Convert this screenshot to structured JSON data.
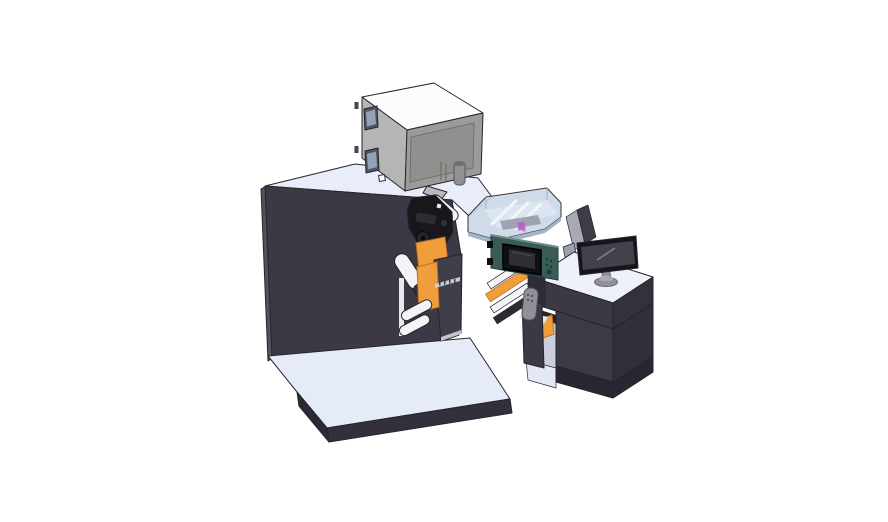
{
  "meta": {
    "description": "Isometric 3D CAD rendering of an industrial label printing press: large dark cabinet with gray feeder box on top, web rollers and orange guide plates, transparent guard enclosure, teal control panel with small display, and an operator desk with a monitor, all on light base platforms against a white background",
    "canvas": {
      "width": 888,
      "height": 522
    },
    "background": "#ffffff"
  },
  "palette": {
    "outline": "#26252e",
    "white": "#ffffff",
    "machineFace": "#3a3944",
    "machineEdge": "#52515c",
    "machineTop": "#e9edf9",
    "deskTop": "#eef1fa",
    "platformTop": "#e6ebf8",
    "platformSide": "#31303b",
    "platformSideDark": "#2b2a34",
    "boxTop": "#fcfcfc",
    "boxLeft": "#b5b5b3",
    "boxFront": "#9b9b99",
    "boxRecess": "#90908e",
    "windowFrame": "#4d5664",
    "windowGlass": "#93a2b6",
    "metalGray": "#909096",
    "metalDark": "#66666c",
    "mechBlack": "#17171c",
    "mechGray": "#3f3e49",
    "orange": "#f09d3c",
    "orangeDark": "#c07426",
    "roller": "#f4f4f7",
    "capDark": "#302f39",
    "teal": "#3a5c56",
    "tealDark": "#223f3a",
    "screenBlack": "#0f0f14",
    "screenInner": "#2f2e37",
    "glassBlue": "#cdd9e8",
    "glassEdge": "#9fb0c4",
    "slatWhite": "#f3f6fa",
    "purple": "#b765c9",
    "bayInterior": "#c9cfdf",
    "bayFloor": "#e3e8f5",
    "monitorBezel": "#15151a",
    "monitorScreen": "#43424c",
    "plinth": "#282731",
    "bandDark": "#32313c",
    "cabLeft": "#3b3a45",
    "cabRight": "#302f3a"
  },
  "objects": [
    {
      "name": "top-feeder-box",
      "label": "Gray feeder / laser unit box on machine top",
      "color": "#9b9b99"
    },
    {
      "name": "main-machine-cabinet",
      "label": "Main press cabinet",
      "color": "#3a3944"
    },
    {
      "name": "print-mechanism",
      "label": "Print head mechanism with gears",
      "color": "#17171c"
    },
    {
      "name": "web-rollers",
      "label": "White web rollers",
      "color": "#f4f4f7"
    },
    {
      "name": "guide-plates",
      "label": "Orange guide plates",
      "color": "#f09d3c"
    },
    {
      "name": "guard-enclosure",
      "label": "Transparent guard enclosure with slats",
      "color": "#cdd9e8"
    },
    {
      "name": "control-panel",
      "label": "Teal control panel with display",
      "color": "#3a5c56"
    },
    {
      "name": "side-display-panel",
      "label": "Auxiliary display panel (back view)",
      "color": "#3e3d47"
    },
    {
      "name": "operator-desk",
      "label": "Operator desk cabinet with open bay",
      "color": "#3b3a45"
    },
    {
      "name": "desktop-monitor",
      "label": "Desktop monitor on oval stand",
      "color": "#15151a"
    },
    {
      "name": "base-platform",
      "label": "Light floor base platform",
      "color": "#e6ebf8"
    },
    {
      "name": "web-bridge",
      "label": "Web path bridge between press and desk",
      "color": "#f09d3c"
    },
    {
      "name": "door-handle",
      "label": "Gray handle with dots",
      "color": "#909096"
    }
  ]
}
